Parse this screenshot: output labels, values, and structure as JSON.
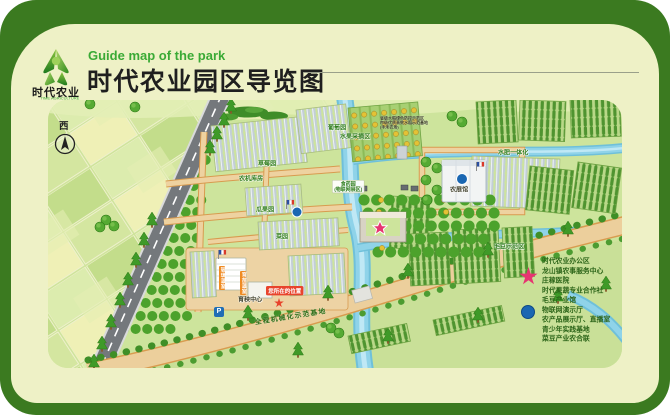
{
  "header": {
    "logo_text": "时代农业",
    "logo_sub": "TIME AGRICULTURE",
    "subtitle_en": "Guide map of the park",
    "title": "时代农业园区导览图"
  },
  "map": {
    "compass": "西",
    "labels": {
      "strawberry": "草莓园",
      "machine_shed": "农机库房",
      "grape": "葡萄园",
      "fruit_picking": "水果采摘区",
      "melon_fruit": "瓜果园",
      "vegetable": "菜园",
      "herb_garden": "食药园",
      "herb_garden_sub": "(物联网展区)",
      "rice_base_1": "省级水稻绿色防控示范区",
      "rice_base_2": "市级优质高效水稻示范基地",
      "rice_base_3": "(丰禾农场)",
      "expo_hall": "农展馆",
      "water_fertilizer": "水肥一体化",
      "soybean_demo": "毛豆示范区",
      "seedling_center": "育秧中心",
      "mech_base": "全程机械化示范基地",
      "glass_greenhouse": "玻璃温室",
      "nursery_greenhouse": "育苗温室",
      "you_are_here": "您所在的位置",
      "parking": "P"
    }
  },
  "legend": {
    "star_items": [
      "时代农业办公区",
      "龙山镇农事服务中心",
      "庄稼医院",
      "时代果蔬专业合作社"
    ],
    "dot_items": [
      "毛豆产业馆",
      "物联网演示厅",
      "农产品展示厅、直播室",
      "青少年实践基地",
      "菜豆产业农合联"
    ]
  },
  "colors": {
    "frame_green": "#3b7a20",
    "card_cream": "#eef1c6",
    "accent_green": "#3aaa35",
    "star_pink": "#e63571",
    "dot_blue": "#1a67b2",
    "here_red": "#e8432c",
    "sign_orange": "#ef8b23"
  }
}
